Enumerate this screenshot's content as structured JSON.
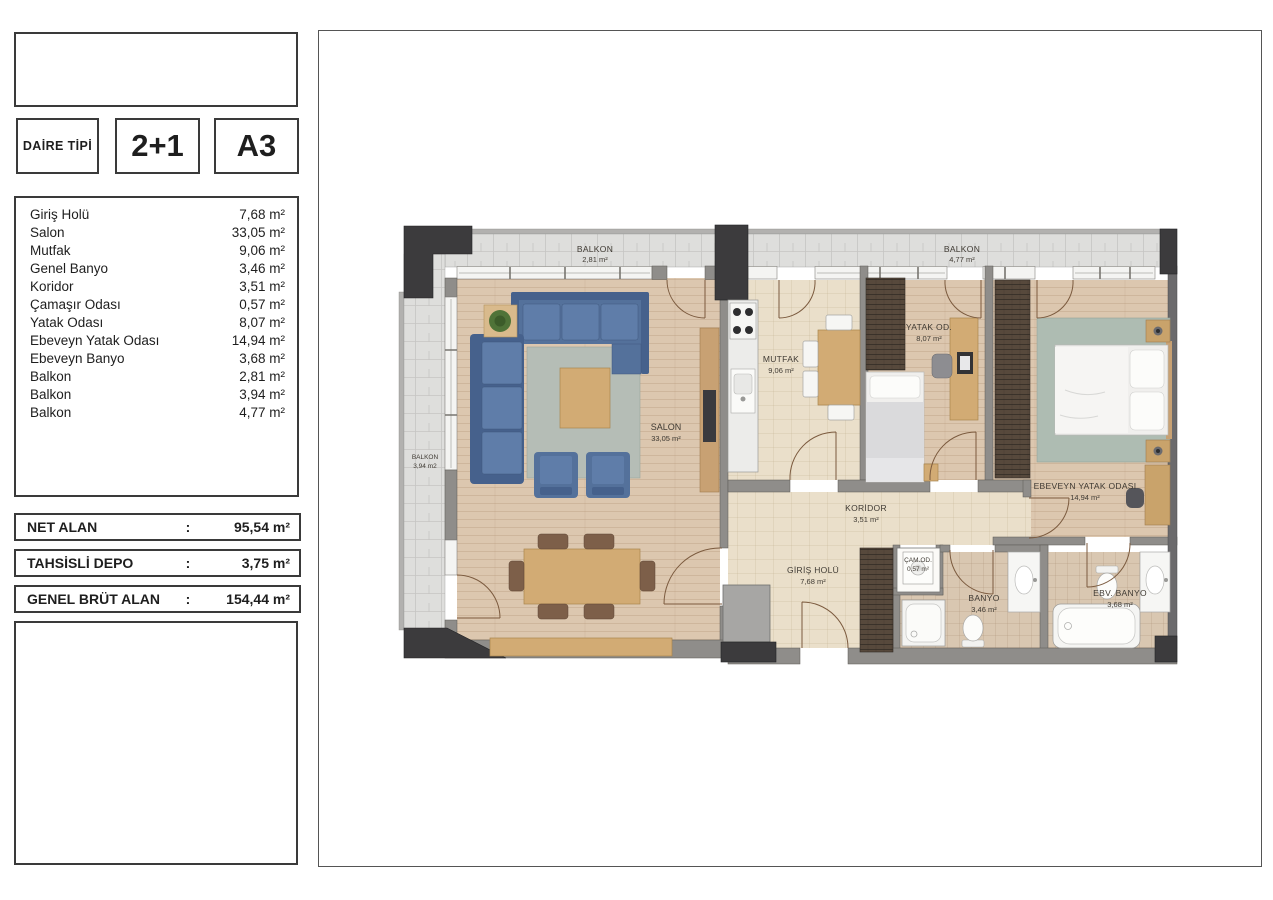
{
  "header": {
    "type_label": "DAİRE TİPİ",
    "type_value": "2+1",
    "unit_code": "A3"
  },
  "room_list": [
    {
      "name": "Giriş Holü",
      "area": "7,68 m²"
    },
    {
      "name": "Salon",
      "area": "33,05 m²"
    },
    {
      "name": "Mutfak",
      "area": "9,06 m²"
    },
    {
      "name": "Genel Banyo",
      "area": "3,46 m²"
    },
    {
      "name": "Koridor",
      "area": "3,51 m²"
    },
    {
      "name": "Çamaşır Odası",
      "area": "0,57 m²"
    },
    {
      "name": "Yatak Odası",
      "area": "8,07 m²"
    },
    {
      "name": "Ebeveyn Yatak Odası",
      "area": "14,94 m²"
    },
    {
      "name": "Ebeveyn Banyo",
      "area": "3,68 m²"
    },
    {
      "name": "Balkon",
      "area": "2,81 m²"
    },
    {
      "name": "Balkon",
      "area": "3,94 m²"
    },
    {
      "name": "Balkon",
      "area": "4,77 m²"
    }
  ],
  "summary": [
    {
      "label": "NET ALAN",
      "colon": ":",
      "value": "95,54 m²"
    },
    {
      "label": "TAHSİSLİ DEPO",
      "colon": ":",
      "value": "3,75 m²"
    },
    {
      "label": "GENEL BRÜT ALAN",
      "colon": ":",
      "value": "154,44 m²"
    }
  ],
  "plan_labels": {
    "balkon_top_left": {
      "name": "BALKON",
      "area": "2,81 m²"
    },
    "balkon_top_right": {
      "name": "BALKON",
      "area": "4,77 m²"
    },
    "balkon_left": {
      "name": "BALKON",
      "area": "3,94 m2"
    },
    "salon": {
      "name": "SALON",
      "area": "33,05 m²"
    },
    "mutfak": {
      "name": "MUTFAK",
      "area": "9,06 m²"
    },
    "yatak_odasi": {
      "name": "YATAK OD.",
      "area": "8,07 m²"
    },
    "ebeveyn_yatak_odasi": {
      "name": "EBEVEYN YATAK ODASI",
      "area": "14,94 m²"
    },
    "koridor": {
      "name": "KORİDOR",
      "area": "3,51 m²"
    },
    "giris_holu": {
      "name": "GİRİŞ HOLÜ",
      "area": "7,68 m²"
    },
    "camasir_odasi": {
      "name": "ÇAM.OD.",
      "area": "0,57 m²"
    },
    "banyo": {
      "name": "BANYO",
      "area": "3,46 m²"
    },
    "ebv_banyo": {
      "name": "EBV. BANYO",
      "area": "3,68 m²"
    }
  },
  "colors": {
    "sofa_blue": "#54719b",
    "wood_floor": "#dcc7af",
    "hall_floor": "#eadfca",
    "bath_floor": "#d9c7b1",
    "rug_gray_green": "#b5bdb6",
    "wall_gray": "#8f8d8a",
    "column_dark": "#3c3b3d"
  }
}
